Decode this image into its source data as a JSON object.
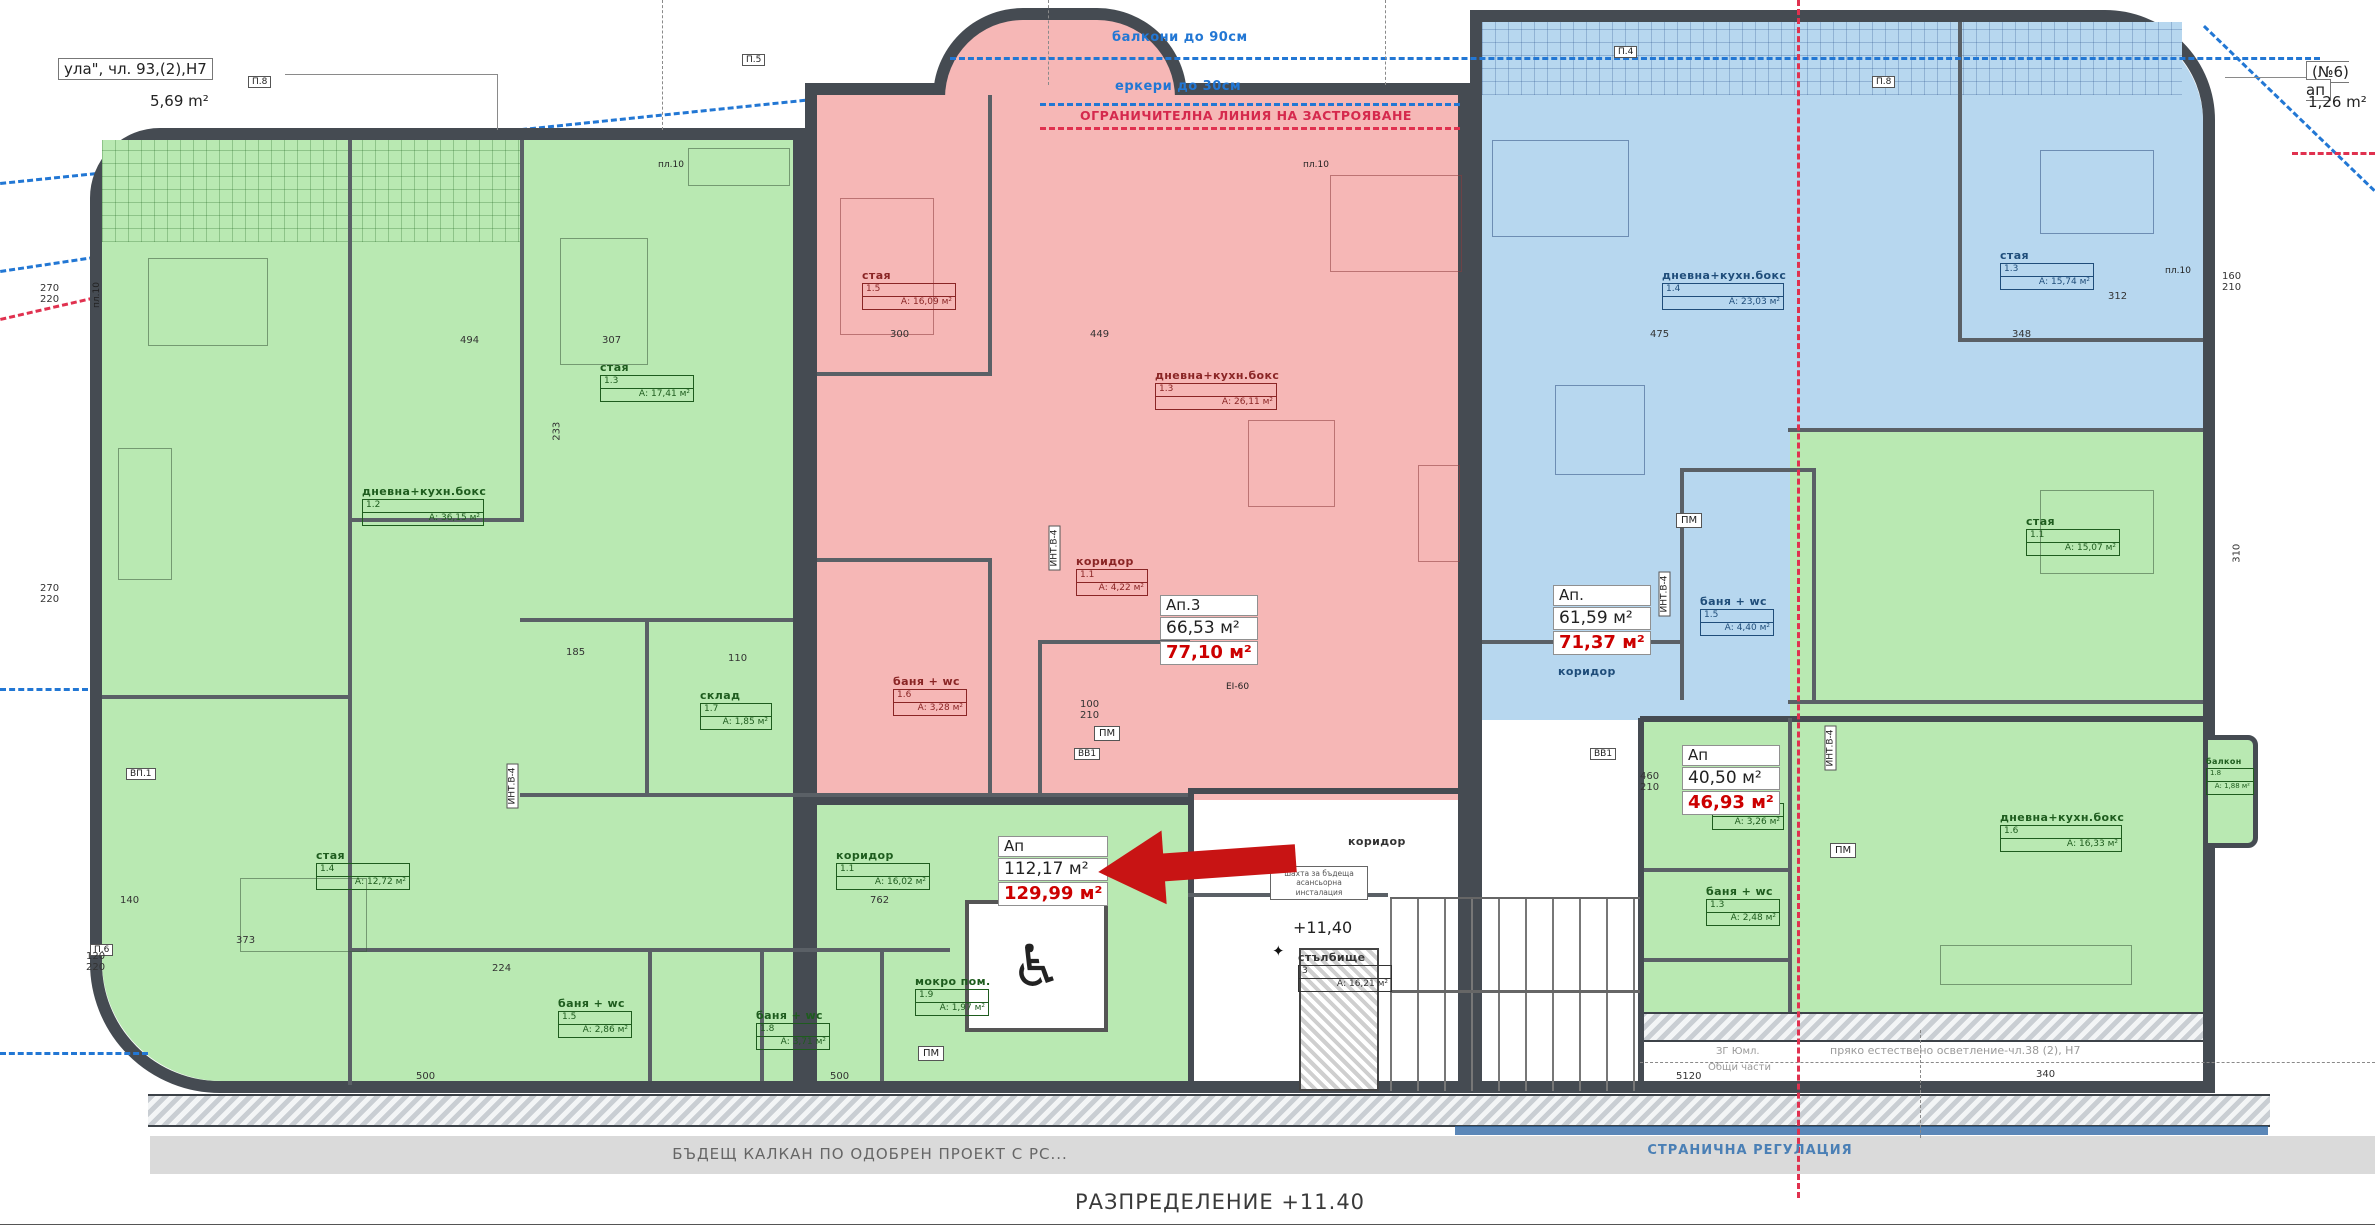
{
  "title": "РАЗПРЕДЕЛЕНИЕ +11.40",
  "colors": {
    "zone_green": "#b9e9b2",
    "zone_red": "#f6b7b6",
    "zone_blue": "#b7d7ef",
    "wall": "#454b52",
    "regulation_blue": "#2277d4",
    "regulation_red": "#e0314f",
    "accent_red": "#cc0000",
    "arrow_red": "#c81414"
  },
  "notes": {
    "top_left_line1": "ула\", чл. 93,(2),Н7",
    "top_left_area": "5,69 m²",
    "balconies": "балкони до 90см",
    "erkers": "еркери до 30см",
    "restriction_line": "ОГРАНИЧИТЕЛНА ЛИНИЯ НА ЗАСТРОЯВАНЕ",
    "top_right_line1": "(№6) ап",
    "top_right_area": "1,26 m²",
    "future_wall": "БЪДЕЩ КАЛКАН ПО ОДОБРЕН ПРОЕКТ С РС...",
    "side_regulation": "СТРАНИЧНА РЕГУЛАЦИЯ",
    "natural_light": "пряко естествено осветление-чл.38 (2), Н7",
    "common_parts_line1": "ЗГ Юмл.",
    "common_parts_line2": "Общи части",
    "level": "+11,40",
    "shaft_note": "шахта за бъдеща\nасансьорна\nинсталация"
  },
  "apartments": [
    {
      "id": "Ап.3",
      "area1": "66,53 м²",
      "area2": "77,10 м²"
    },
    {
      "id": "Ап.",
      "area1": "61,59 м²",
      "area2": "71,37 м²"
    },
    {
      "id": "Ап",
      "area1": "40,50 м²",
      "area2": "46,93 м²"
    },
    {
      "id": "Ап",
      "area1": "112,17 м²",
      "area2": "129,99 м²"
    }
  ],
  "stair": {
    "name": "стълбище",
    "code": "3",
    "area": "А: 16,21 м²"
  },
  "rooms": [
    {
      "name": "стая",
      "code": "1.3",
      "area": "А: 17,41 м²"
    },
    {
      "name": "дневна+кухн.бокс",
      "code": "1.2",
      "area": "А: 36,15 м²"
    },
    {
      "name": "стая",
      "code": "1.4",
      "area": "А: 12,72 м²"
    },
    {
      "name": "коридор",
      "code": "1.1",
      "area": "А: 16,02 м²"
    },
    {
      "name": "склад",
      "code": "1.7",
      "area": "А: 1,85 м²"
    },
    {
      "name": "баня + wc",
      "code": "1.5",
      "area": "А: 2,86 м²"
    },
    {
      "name": "баня + wc",
      "code": "1.8",
      "area": "А: 3,71 м²"
    },
    {
      "name": "мокро пом.",
      "code": "1.9",
      "area": "А: 1,97 м²"
    },
    {
      "name": "стая",
      "code": "1.5",
      "area": "А: 16,09 м²"
    },
    {
      "name": "дневна+кухн.бокс",
      "code": "1.3",
      "area": "А: 26,11 м²"
    },
    {
      "name": "коридор",
      "code": "1.1",
      "area": "А: 4,22 м²"
    },
    {
      "name": "баня + wc",
      "code": "1.6",
      "area": "А: 3,28 м²"
    },
    {
      "name": "дневна+кухн.бокс",
      "code": "1.4",
      "area": "А: 23,03 м²"
    },
    {
      "name": "стая",
      "code": "1.3",
      "area": "А: 15,74 м²"
    },
    {
      "name": "баня + wc",
      "code": "1.5",
      "area": "А: 4,40 м²"
    },
    {
      "name": "коридор",
      "code": "",
      "area": ""
    },
    {
      "name": "стая",
      "code": "1.1",
      "area": "А: 15,07 м²"
    },
    {
      "name": "дневна+кухн.бокс",
      "code": "1.6",
      "area": "А: 16,33 м²"
    },
    {
      "name": "коридор",
      "code": "1.2",
      "area": "А: 3,26 м²"
    },
    {
      "name": "баня + wc",
      "code": "1.3",
      "area": "А: 2,48 м²"
    },
    {
      "name": "балкон",
      "code": "1.8",
      "area": "А: 1,88 м²"
    },
    {
      "name": "коридор",
      "code": "",
      "area": ""
    }
  ],
  "pm_label": "ПМ",
  "wall_tags": [
    "П.8",
    "П.5",
    "П.4",
    "П.8",
    "ВП.1",
    "П.6"
  ],
  "pl_tags": [
    "пл.10",
    "пл.10",
    "пл.10",
    "пл.10"
  ],
  "door_tags": [
    "ИНТ.В-4",
    "ИНТ.В-4",
    "ИНТ.В-4",
    "ИНТ.В-4"
  ],
  "misc_tags": [
    "ВВ1",
    "ВВ1",
    "EI-60"
  ],
  "dims": [
    "494",
    "307",
    "300",
    "449",
    "475",
    "348",
    "270\n220",
    "270\n220",
    "120\n220",
    "233",
    "185",
    "110",
    "140",
    "373",
    "224",
    "500",
    "500",
    "762",
    "5120",
    "340",
    "460\n210",
    "100\n210",
    "160\n210",
    "310",
    "312"
  ],
  "icons": {
    "wheelchair": "♿",
    "level_mark": "✦"
  }
}
